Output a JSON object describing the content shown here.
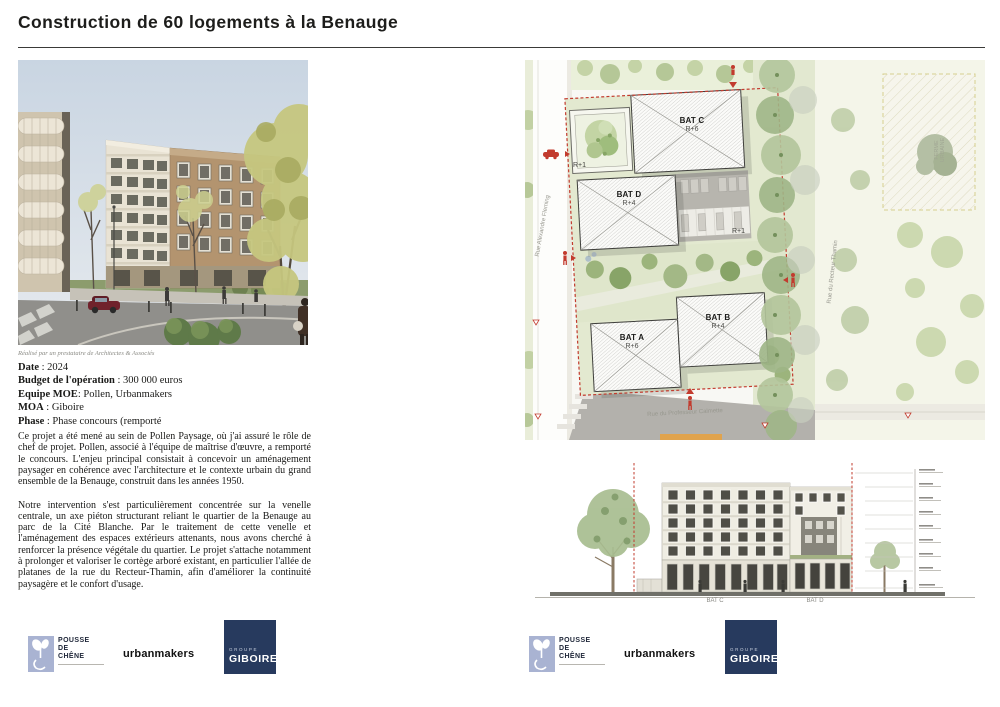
{
  "title": "Construction de 60 logements à la Benauge",
  "project": {
    "caption": "Réalisé par un prestataire de Architectes & Associés",
    "details": [
      {
        "label": "Date",
        "sep": " : ",
        "value": "2024"
      },
      {
        "label": "Budget de l'opération",
        "sep": " : ",
        "value": "300 000 euros"
      },
      {
        "label": "Equipe MOE",
        "sep": ": ",
        "value": "Pollen, Urbanmakers"
      },
      {
        "label": "MOA",
        "sep": " : ",
        "value": "Giboire"
      },
      {
        "label": "Phase",
        "sep": " : ",
        "value": "Phase concours (remporté"
      }
    ],
    "paragraphs": [
      "Ce projet a été mené au sein de Pollen Paysage, où j'ai assuré le rôle de chef de projet. Pollen, associé à l'équipe de maîtrise d'œuvre, a remporté le concours. L'enjeu principal consistait à concevoir un aménagement paysager en cohérence avec l'architecture et le contexte urbain du grand ensemble de la Benauge, construit dans les années 1950.",
      "Notre intervention s'est particulièrement concentrée sur la venelle centrale, un axe piéton structurant reliant le quartier de la Benauge au parc de la Cité Blanche. Par le traitement de cette venelle et l'aménagement des espaces extérieurs attenants, nous avons cherché à renforcer la présence végétale du quartier. Le projet s'attache notamment à prolonger et valoriser le cortège arboré existant, en particulier l'allée de platanes de la rue du Recteur-Thamin, afin d'améliorer la continuité paysagère et le confort d'usage."
    ]
  },
  "site_plan": {
    "buildings": [
      {
        "name": "BAT C",
        "level": "R+6"
      },
      {
        "name": "BAT D",
        "level": "R+4"
      },
      {
        "name": "BAT A",
        "level": "R+6"
      },
      {
        "name": "BAT B",
        "level": "R+4"
      }
    ],
    "height_labels": [
      "R+1",
      "R+1"
    ],
    "streets": {
      "left": "Rue Alexandre Fleming",
      "right": "Rue du Recteur Thamin",
      "bottom": "Rue du Professeur Calmette"
    },
    "zone": "FERME URBAINE"
  },
  "elevation": {
    "building_labels": [
      "BAT C",
      "BAT D"
    ]
  },
  "logos": {
    "pousse_de_chene": {
      "lines": [
        "POUSSE",
        "DE",
        "CHÊNE"
      ]
    },
    "urbanmakers": "urbanmakers",
    "giboire": {
      "group": "GROUPE",
      "name": "GIBOIRE"
    }
  },
  "colors": {
    "accent_red": "#c23b2e",
    "navy": "#273a5e",
    "periwinkle": "#a9b3d2"
  }
}
